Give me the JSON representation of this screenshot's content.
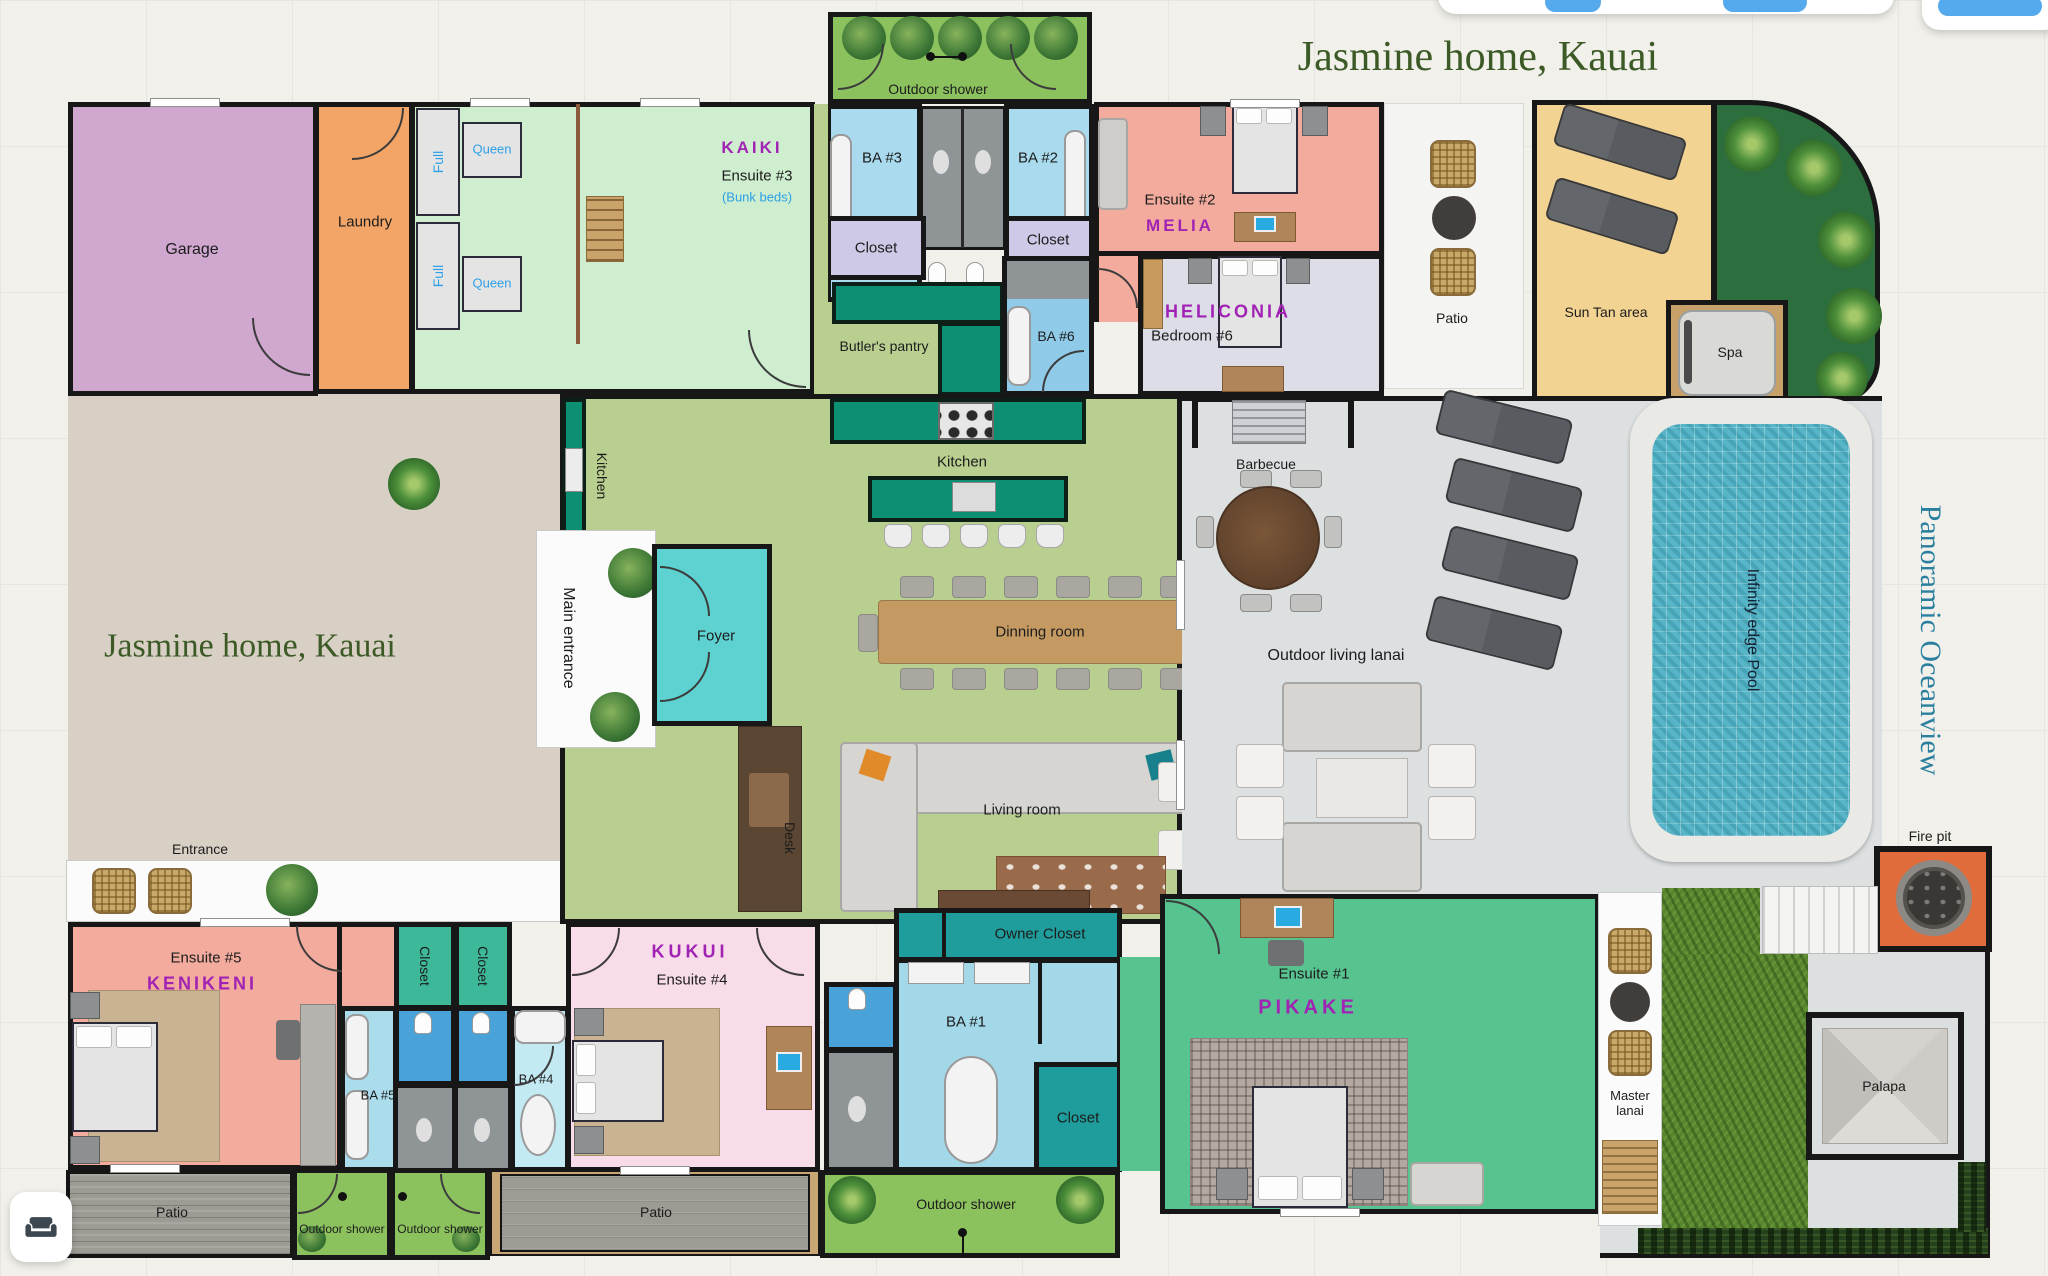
{
  "title": {
    "main": "Jasmine home, Kauai",
    "watermark": "Jasmine home, Kauai"
  },
  "labels": {
    "garage": "Garage",
    "laundry": "Laundry",
    "full_1": "Full",
    "full_2": "Full",
    "queen_1": "Queen",
    "queen_2": "Queen",
    "kaiki": "KAIKI",
    "ensuite_3": "Ensuite #3",
    "bunk_beds": "(Bunk beds)",
    "outdoor_shower_top": "Outdoor shower",
    "ba_3": "BA #3",
    "ba_2": "BA #2",
    "closet_ba3": "Closet",
    "closet_ba2": "Closet",
    "ensuite_2": "Ensuite #2",
    "melia": "MELIA",
    "heliconia": "HELICONIA",
    "bedroom_6": "Bedroom #6",
    "ba_6": "BA #6",
    "butlers_pantry": "Butler's pantry",
    "kitchen": "Kitchen",
    "kitchen_side": "Kitchen",
    "patio_top": "Patio",
    "sun_tan": "Sun Tan area",
    "spa": "Spa",
    "barbecue": "Barbecue",
    "lanai": "Outdoor living lanai",
    "pool": "Infinity edge Pool",
    "oceanview": "Panoramic Oceanview",
    "fire_pit": "Fire pit",
    "main_entrance": "Main entrance",
    "foyer": "Foyer",
    "dining": "Dinning room",
    "living": "Living room",
    "desk": "Desk",
    "entrance": "Entrance",
    "ensuite_5": "Ensuite #5",
    "kenikeni": "KENIKENI",
    "closet_k": "Closet",
    "ba_5": "BA #5",
    "closet_c1": "Closet",
    "closet_c2": "Closet",
    "ba_4": "BA #4",
    "kukui": "KUKUI",
    "ensuite_4": "Ensuite #4",
    "ba_1": "BA #1",
    "owner_closet": "Owner Closet",
    "closet_ba1": "Closet",
    "ensuite_1": "Ensuite #1",
    "pikake": "PIKAKE",
    "master_lanai": "Master lanai",
    "palapa": "Palapa",
    "patio_bl": "Patio",
    "outdoor_shower_b1": "Outdoor shower",
    "outdoor_shower_b2": "Outdoor shower",
    "patio_bm": "Patio",
    "outdoor_shower_b3": "Outdoor shower"
  },
  "colors": {
    "room_name_purple": "#a123b4",
    "bed_label_blue": "#2da0e8",
    "title_green": "#3c5a26",
    "oceanview_teal": "#2b7f9e",
    "accent_blue": "#55aaee"
  }
}
